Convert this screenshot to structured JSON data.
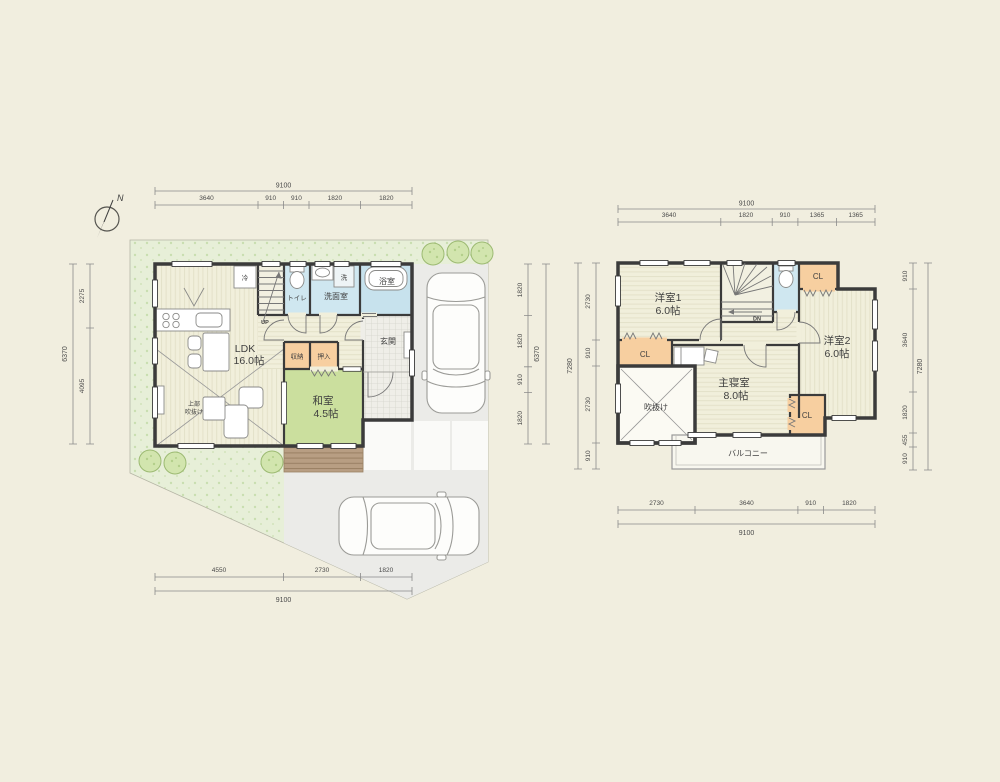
{
  "compass": {
    "label": "N"
  },
  "floor1": {
    "rooms": {
      "ldk_name": "LDK",
      "ldk_size": "16.0帖",
      "washitsu_name": "和室",
      "washitsu_size": "4.5帖",
      "genkan": "玄関",
      "toilet": "トイレ",
      "senmenshitsu": "洗面室",
      "bath": "浴室",
      "washer": "洗",
      "fridge": "冷",
      "shuno": "収納",
      "oshiire": "押入",
      "void_line1": "上部",
      "void_line2": "吹抜け",
      "stairs_up": "UP"
    },
    "dims": {
      "top": {
        "total": "9100",
        "segments": [
          "3640",
          "910",
          "910",
          "1820",
          "1820"
        ]
      },
      "left": {
        "total": "6370",
        "segments": [
          "2275",
          "4095"
        ]
      },
      "right": {
        "total": "6370",
        "segments": [
          "1820",
          "1820",
          "910",
          "1820"
        ]
      },
      "bottom": {
        "total": "9100",
        "segments": [
          "4550",
          "2730",
          "1820"
        ]
      }
    }
  },
  "floor2": {
    "rooms": {
      "yoshitsu1_name": "洋室1",
      "yoshitsu1_size": "6.0帖",
      "yoshitsu2_name": "洋室2",
      "yoshitsu2_size": "6.0帖",
      "shinshitsu_name": "主寝室",
      "shinshitsu_size": "8.0帖",
      "fukinuke": "吹抜け",
      "balcony": "バルコニー",
      "cl_left": "CL",
      "cl_topright": "CL",
      "cl_bottomright": "CL",
      "stairs_dn": "DN"
    },
    "dims": {
      "top": {
        "total": "9100",
        "segments": [
          "3640",
          "1820",
          "910",
          "1365",
          "1365"
        ]
      },
      "left": {
        "total": "7280",
        "segments": [
          "2730",
          "910",
          "2730",
          "910"
        ]
      },
      "right": {
        "total": "7280",
        "segments": [
          "910",
          "3640",
          "1820",
          "455",
          "910"
        ]
      },
      "bottom": {
        "total": "9100",
        "segments": [
          "2730",
          "3640",
          "910",
          "1820"
        ]
      }
    }
  },
  "colors": {
    "background": "#f1eedf",
    "wall": "#3b3b3b",
    "wood_floor": "#f1efdb",
    "tatami_green": "#cbdf9e",
    "water_blue": "#cfe7f0",
    "closet_orange": "#f7cfa0",
    "garden_green": "#e7efd8",
    "driveway_gray": "#ebebe8",
    "deck_brown": "#b89e83",
    "balcony_white": "#f8f7ef"
  }
}
